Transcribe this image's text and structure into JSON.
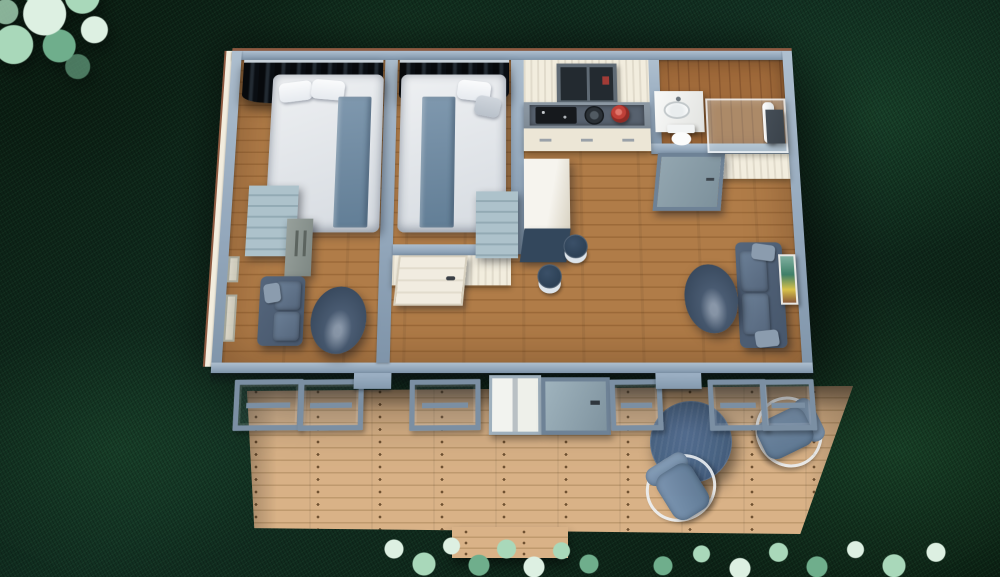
{
  "scene": {
    "description": "Aerial top-down 3D cutaway render of a small two-bedroom house floor plan on a dark green lawn, with a wooden deck, round patio table and two chairs, and light green tree and shrub foliage",
    "colors": {
      "grass_base": "#123022",
      "grass_dark": "#0a1c11",
      "foliage_light": "#ddf0e2",
      "foliage_mid": "#a9d8ba",
      "foliage_dark": "#6fae8c",
      "deck_wood": "#d9b287",
      "deck_wood_dark": "#bf9a6e",
      "deck_nail": "#6f5131",
      "floor_wood": "#b07c48",
      "floor_wood_dark": "#9c6a39",
      "bath_wood": "#a06a3a",
      "bath_wood_dark": "#8a5830",
      "wall_cap": "#93a7bb",
      "wall_cap_light": "#aebfcf",
      "wall_cap_dark": "#7f94a9",
      "wall_face": "#f2edde",
      "roof_edge": "#8e5a41",
      "curtain_dark": "#07090c",
      "curtain_light": "#232b33",
      "bed_sheet": "#eef0f2",
      "bed_shade": "#d6dbe1",
      "bed_runner": "#7f98ae",
      "bed_runner_dark": "#627e96",
      "pillow_white": "#e6eaef",
      "dresser_light": "#adc2cb",
      "dresser_dark": "#97a09b",
      "sofa_dark": "#46566b",
      "sofa_mid": "#55667c",
      "sofa_light": "#6b7f96",
      "table_oval": "#3c4d62",
      "counter_frame": "#7e8a95",
      "counter_panel": "#57616e",
      "appliance_black": "#16191d",
      "pot_dark": "#2a3036",
      "pot_red": "#c04038",
      "cabinet_white": "#ece6d6",
      "window_dark": "#232a30",
      "window_frame": "#5f6a74",
      "door_white": "#f1ece0",
      "door_glass": "#93a6b0",
      "door_glass_frame": "#6e8296",
      "island_white": "#f6f4ee",
      "island_shade": "#d8d2c2",
      "desk_navy": "#33475c",
      "stool_navy": "#2c4055",
      "stool_base": "#dde4ea",
      "fixture_white": "#fbfcfc",
      "wall_cabinet": "#3a424a",
      "patio_table": "#4a6585",
      "chair_cushion": "#7d97b3",
      "chair_cushion_dark": "#5e7893",
      "chair_frame": "#eef2f5",
      "band_frame": "#7b8fa3",
      "pillar_blue": "#9db1c5",
      "art_yellow": "#d8c24a"
    },
    "house": {
      "rooms": [
        {
          "name": "bedroom-1",
          "objects": [
            "double-bed",
            "blackout-curtains",
            "blue-runner-blanket",
            "pillows",
            "dresser",
            "wardrobe",
            "loveseat",
            "oval-side-table",
            "west-wall-windows"
          ]
        },
        {
          "name": "bedroom-2",
          "objects": [
            "double-bed",
            "blackout-curtains",
            "blue-runner-blanket",
            "pillows",
            "dresser",
            "white-interior-door"
          ]
        },
        {
          "name": "kitchen",
          "objects": [
            "window",
            "countertop",
            "coffee-machine",
            "cooktop-pot",
            "red-pot",
            "base-cabinets",
            "white-island",
            "navy-desk-panel",
            "bar-stool",
            "bar-stool"
          ]
        },
        {
          "name": "bathroom",
          "objects": [
            "vanity-sink",
            "toilet",
            "glass-shower",
            "towel",
            "wall-cabinet",
            "frosted-glass-door"
          ]
        },
        {
          "name": "living-area",
          "objects": [
            "sofa",
            "oval-coffee-table",
            "wall-art"
          ]
        }
      ],
      "south_wall": [
        "window",
        "window",
        "wall-pillar",
        "window",
        "white-double-door",
        "glass-entry-door",
        "window",
        "wall-pillar",
        "window",
        "window"
      ]
    },
    "deck": {
      "objects": [
        "round-patio-table",
        "patio-chair",
        "patio-chair",
        "entry-step"
      ]
    },
    "landscape": {
      "objects": [
        "tree-canopy",
        "shrub-cluster",
        "shrub-cluster",
        "lawn"
      ]
    }
  }
}
